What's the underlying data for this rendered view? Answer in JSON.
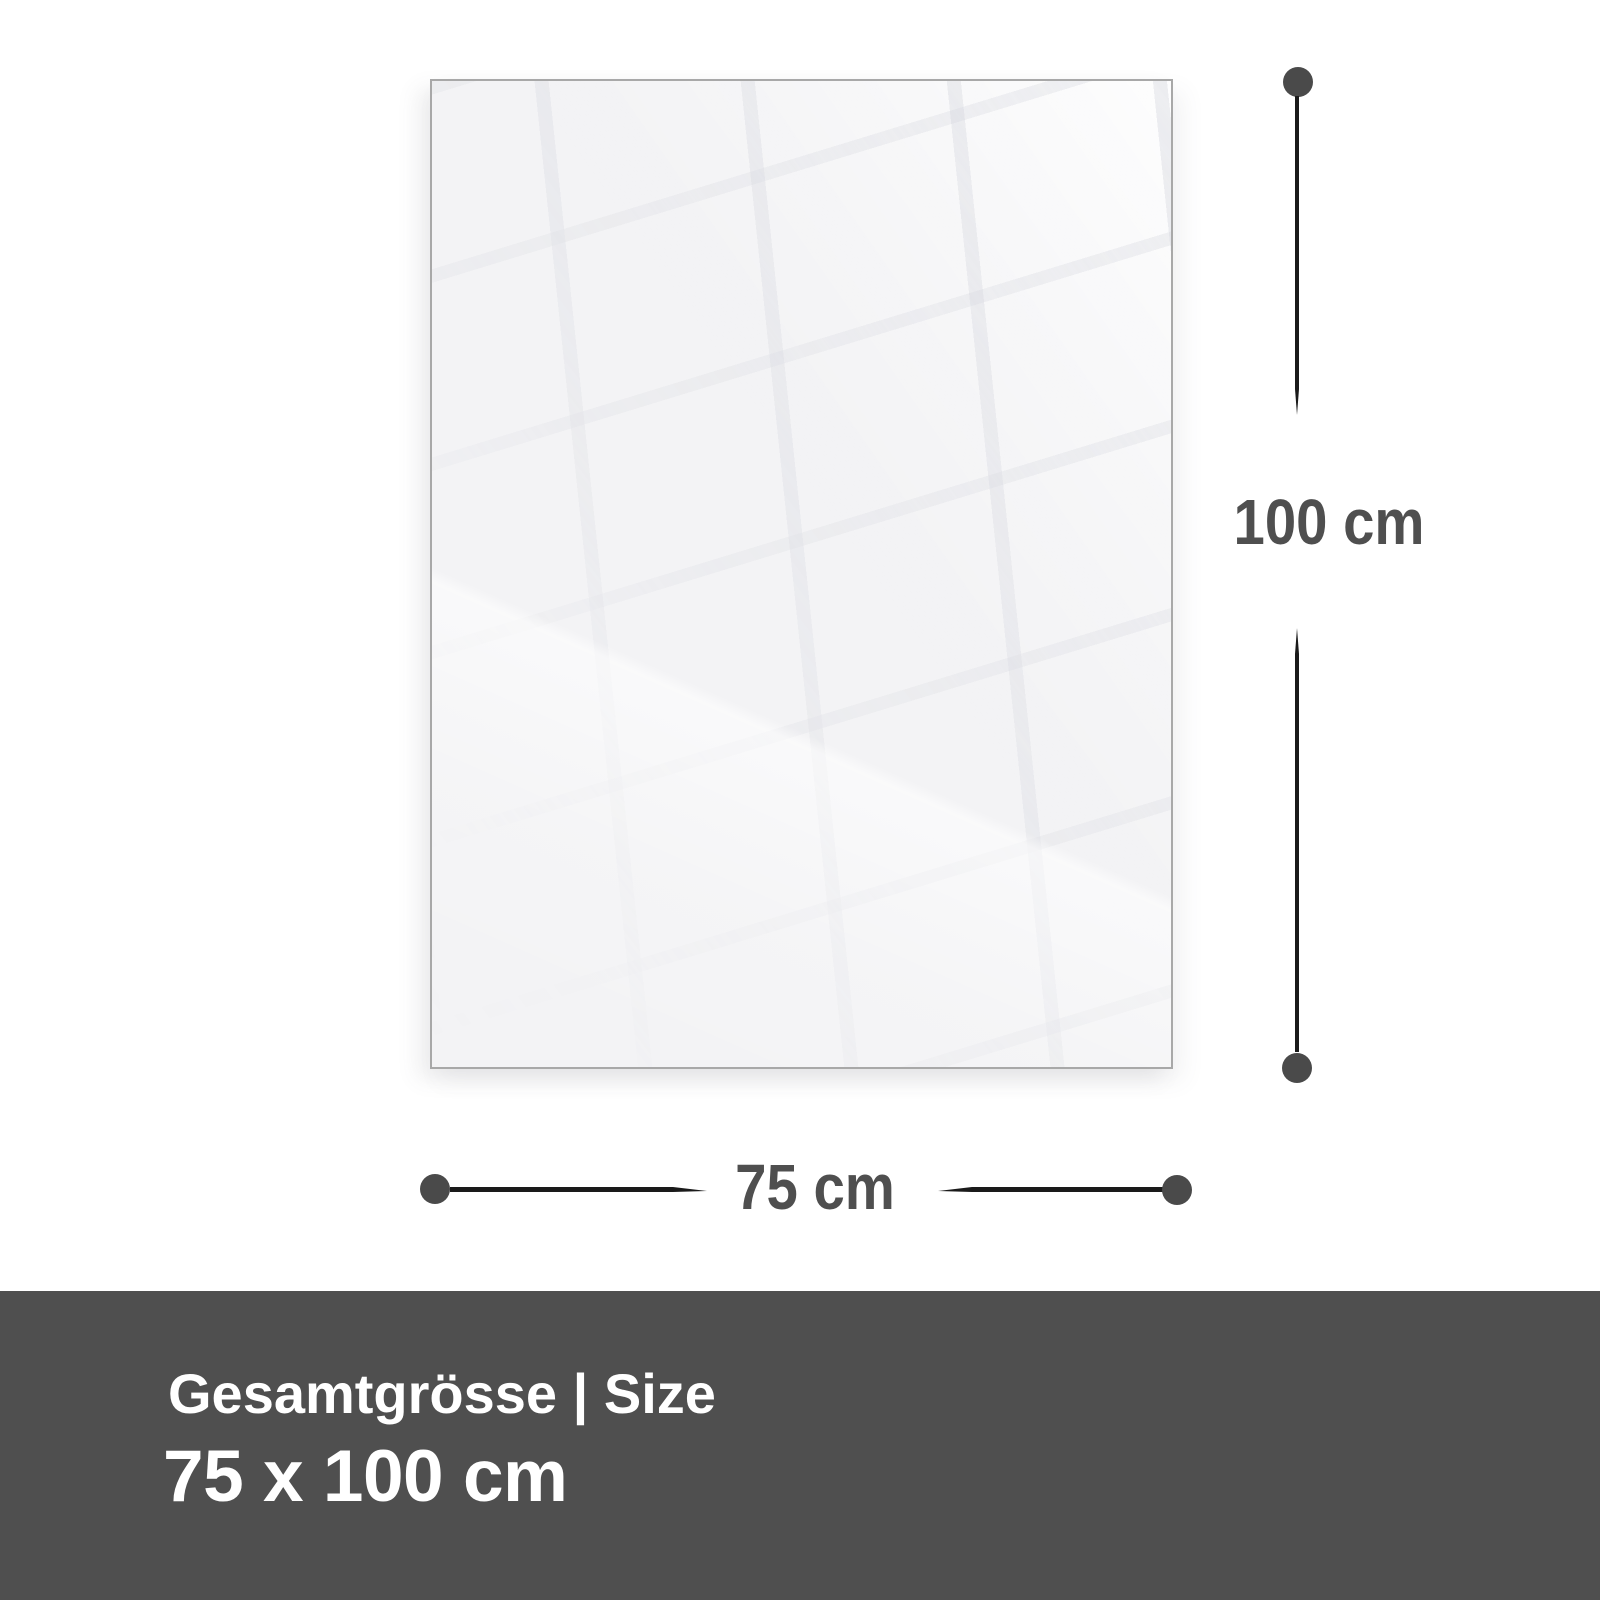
{
  "dimensions": {
    "height": {
      "label": "100 cm"
    },
    "width": {
      "label": "75 cm"
    }
  },
  "footer": {
    "heading": "Gesamtgrösse | Size",
    "value": "75 x 100 cm"
  },
  "colors": {
    "line": "#1a1a1a",
    "dot": "#4a4a4a",
    "dim_label": "#4f4f4f",
    "footer_bg": "#4f4f4f",
    "footer_text": "#ffffff",
    "panel_bg": "#f3f3f5",
    "panel_border": "#a8a8a8",
    "page_bg": "#ffffff"
  }
}
